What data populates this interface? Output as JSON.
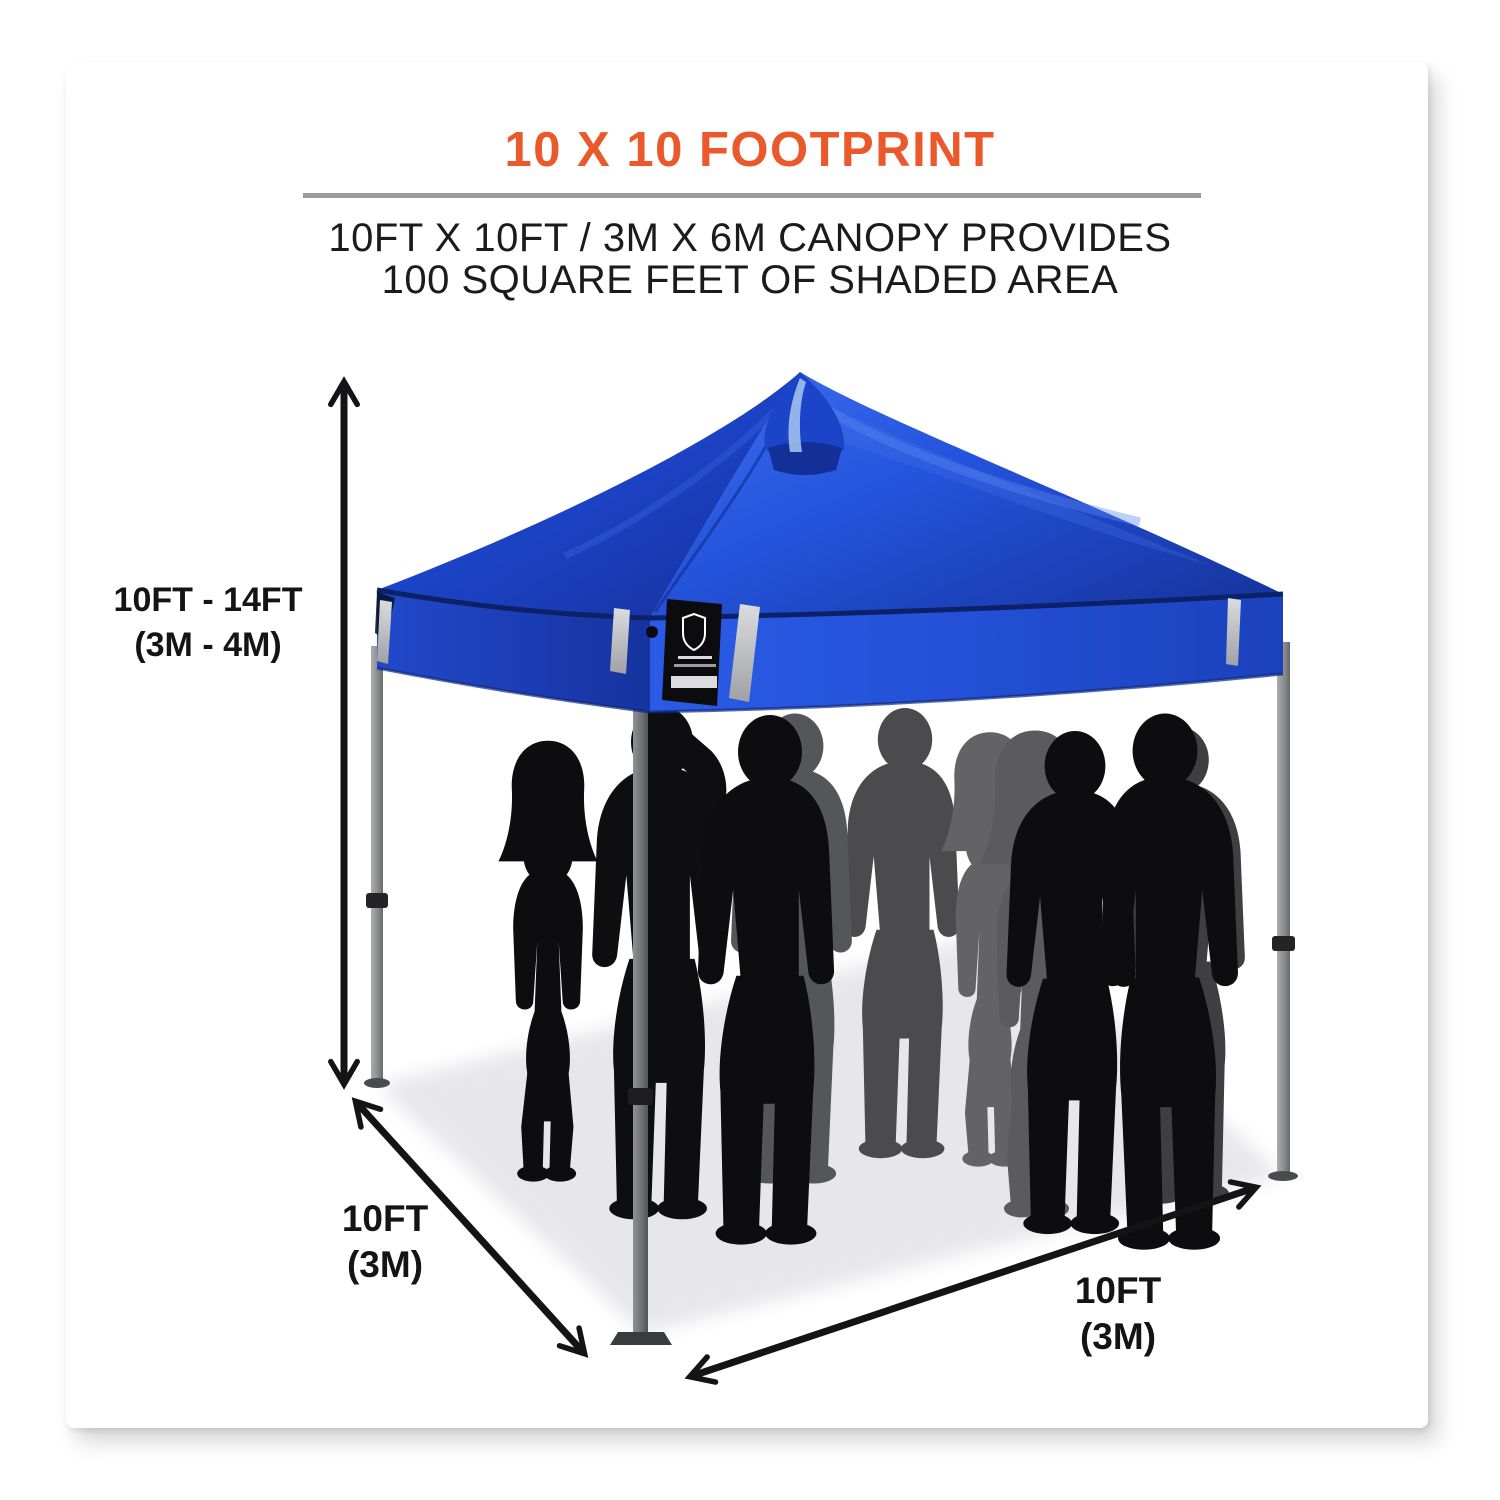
{
  "header": {
    "title": "10 X 10 FOOTPRINT",
    "subtitle_line1": "10FT X 10FT / 3M X 6M CANOPY PROVIDES",
    "subtitle_line2": "100 SQUARE FEET OF SHADED AREA"
  },
  "dimensions": {
    "height": {
      "line1": "10FT - 14FT",
      "line2": "(3M - 4M)"
    },
    "depth": {
      "line1": "10FT",
      "line2": "(3M)"
    },
    "width": {
      "line1": "10FT",
      "line2": "(3M)"
    }
  },
  "graphics": {
    "title_color": "#EB582B",
    "divider_color": "#9B9B9B",
    "text_color": "#1B1B1D",
    "arrow_color": "#141416",
    "canopy_blue": "#2453DC",
    "canopy_dark_blue": "#16349E",
    "canopy_highlight_blue": "#5D87F2",
    "pole_gray": "#98999B",
    "ground_shadow_color": "#E7E7EA",
    "silhouette_black": "#0D0D0F",
    "silhouette_gray": "#5A5A5C",
    "people_count": 10,
    "illustration": "blue pop-up canopy tent with peaked vent top, reflective strips, black brand patch, group of people standing beneath"
  }
}
